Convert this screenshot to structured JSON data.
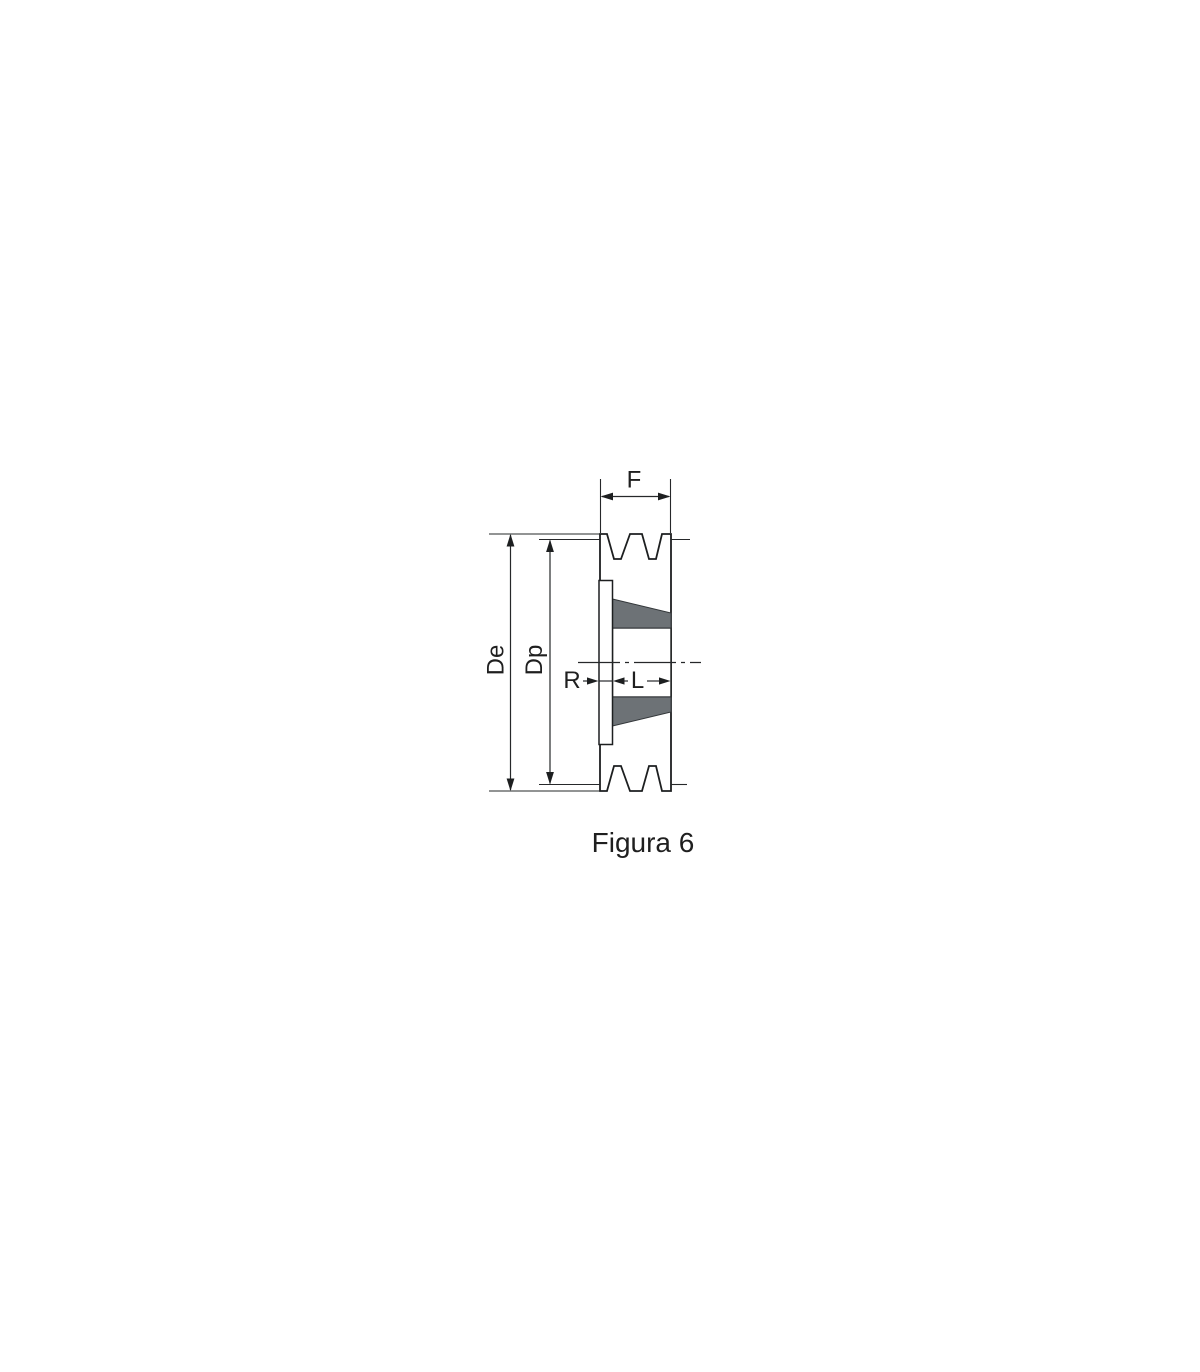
{
  "figure": {
    "caption": "Figura 6",
    "labels": {
      "face_width": "F",
      "outer_diameter": "De",
      "pitch_diameter": "Dp",
      "flange_protrusion": "R",
      "bushing_length": "L"
    },
    "colors": {
      "background": "#ffffff",
      "body_fill": "#b6babc",
      "taper_fill": "#6d7276",
      "outline": "#1d1f20",
      "dimension_line": "#26282a",
      "text": "#1f1f1f"
    }
  }
}
